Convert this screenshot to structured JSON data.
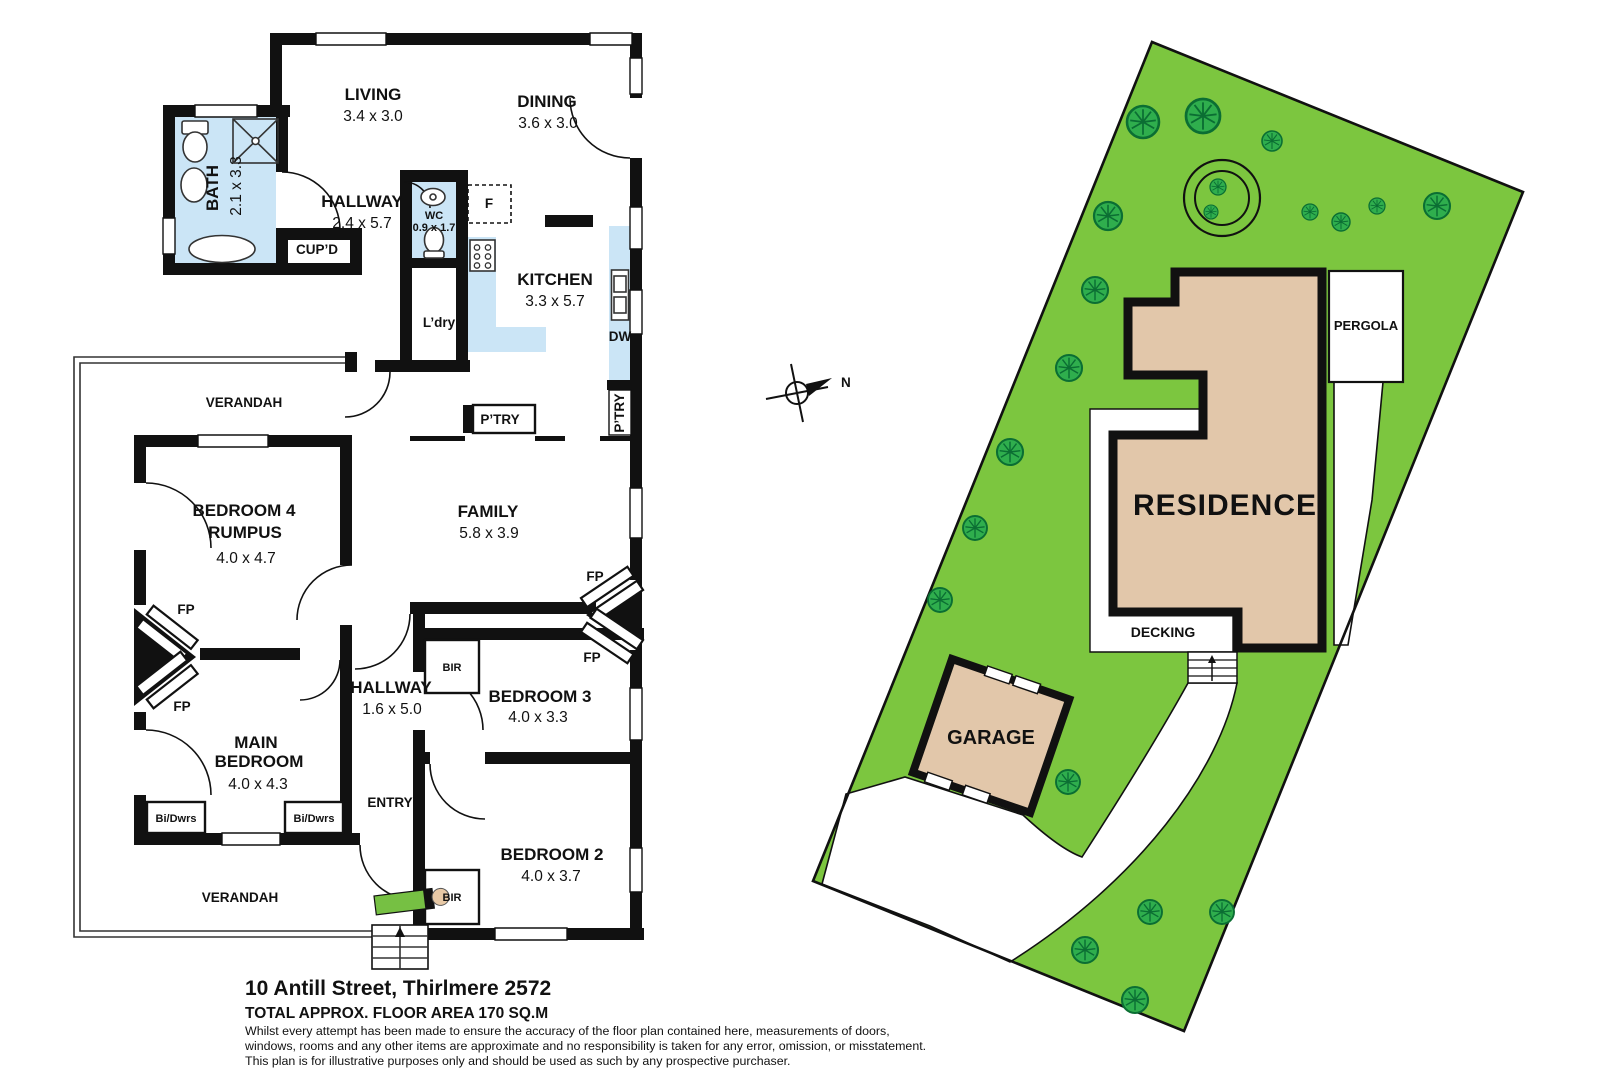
{
  "floor_plan": {
    "rooms": [
      {
        "name": "LIVING",
        "dims": "3.4 x 3.0"
      },
      {
        "name": "DINING",
        "dims": "3.6 x 3.0"
      },
      {
        "name": "BATH",
        "dims": "2.1 x 3.3"
      },
      {
        "name": "HALLWAY",
        "dims": "2.4 x 5.7"
      },
      {
        "name": "WC",
        "dims": "0.9 x 1.7"
      },
      {
        "name": "KITCHEN",
        "dims": "3.3 x 5.7"
      },
      {
        "name": "BEDROOM 4",
        "name2": "RUMPUS",
        "dims": "4.0 x 4.7"
      },
      {
        "name": "FAMILY",
        "dims": "5.8 x 3.9"
      },
      {
        "name": "HALLWAY",
        "dims": "1.6 x 5.0"
      },
      {
        "name": "BEDROOM 3",
        "dims": "4.0 x 3.3"
      },
      {
        "name": "MAIN",
        "name2": "BEDROOM",
        "dims": "4.0 x 4.3"
      },
      {
        "name": "BEDROOM 2",
        "dims": "4.0 x 3.7"
      }
    ],
    "labels": {
      "cupd": "CUP’D",
      "f": "F",
      "ldry": "L’dry",
      "dw": "DW",
      "ptry": "P’TRY",
      "ptry2": "P’TRY",
      "verandah": "VERANDAH",
      "verandah2": "VERANDAH",
      "entry": "ENTRY",
      "fp": "FP",
      "bir": "BIR",
      "bidwrs": "Bi/Dwrs"
    }
  },
  "site_plan": {
    "residence": "RESIDENCE",
    "garage": "GARAGE",
    "pergola": "PERGOLA",
    "decking": "DECKING",
    "north": "N"
  },
  "footer": {
    "address": "10 Antill Street, Thirlmere 2572",
    "area": "TOTAL APPROX. FLOOR AREA 170 SQ.M",
    "disclaimer": [
      "Whilst every attempt has been made to ensure the accuracy of the floor plan contained here, measurements of doors,",
      "windows, rooms and any other items are approximate and no responsibility is taken for any error, omission, or misstatement.",
      "This plan is for illustrative purposes only and should be used as such by any prospective purchaser."
    ]
  },
  "colors": {
    "lot_green": "#7cc63f",
    "tree_green": "#2fae4d",
    "tree_dark": "#0b6e33",
    "building_tan": "#e2c7aa",
    "wet_blue": "#cbe5f6",
    "wall": "#111111",
    "mat_green": "#76c043"
  }
}
